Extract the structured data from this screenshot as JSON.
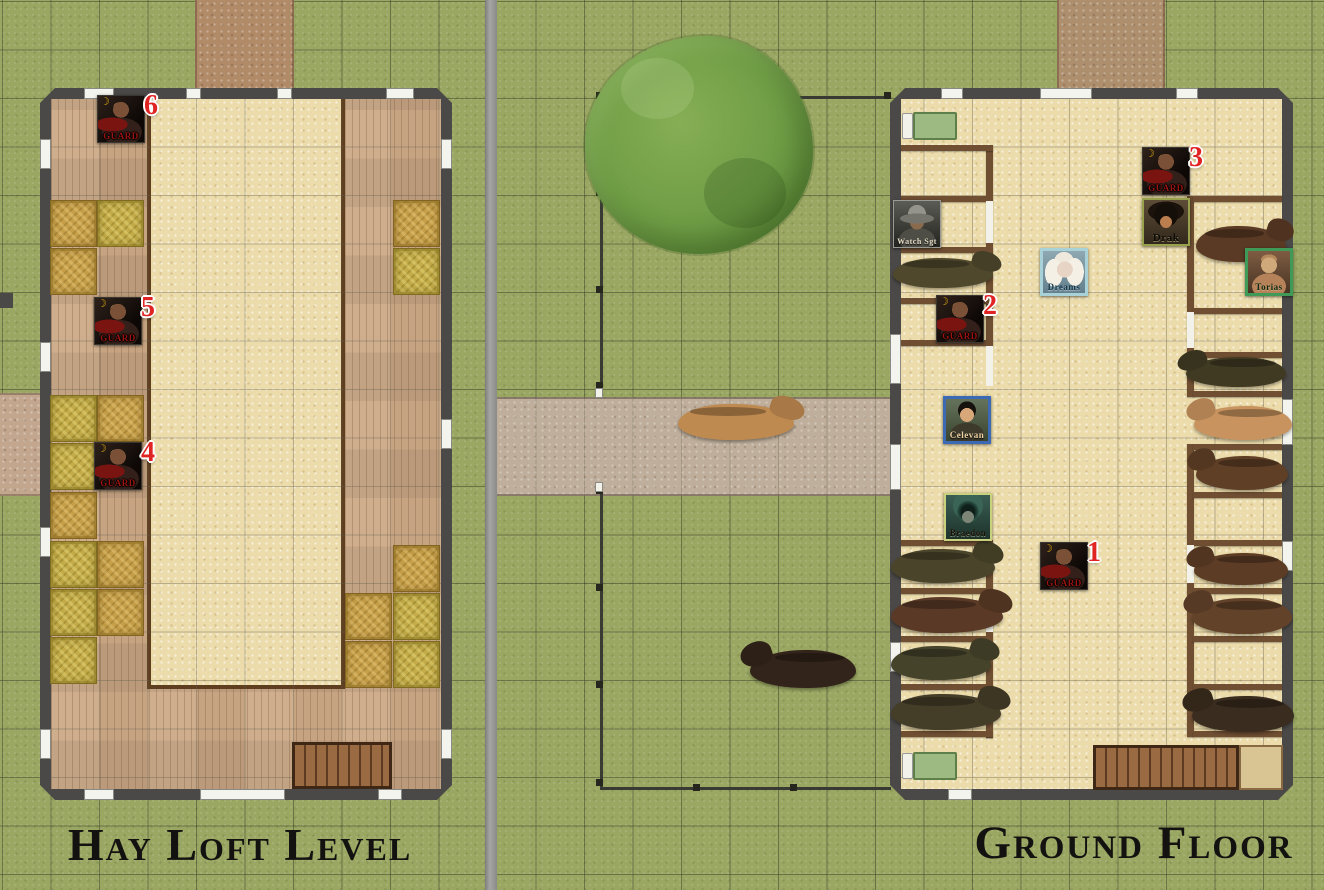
{
  "left_panel": {
    "title": "Hay Loft Level",
    "tokens": [
      {
        "id": "guard-6",
        "type": "guard",
        "label": "Guard",
        "number": "6",
        "status_icon": "crescent",
        "x": 97,
        "y": 95
      },
      {
        "id": "guard-5",
        "type": "guard",
        "label": "Guard",
        "number": "5",
        "status_icon": "crescent",
        "x": 94,
        "y": 297
      },
      {
        "id": "guard-4",
        "type": "guard",
        "label": "Guard",
        "number": "4",
        "status_icon": "crescent",
        "x": 94,
        "y": 442
      }
    ],
    "hay_bales": [
      [
        50,
        200
      ],
      [
        97,
        200
      ],
      [
        50,
        248
      ],
      [
        50,
        395
      ],
      [
        97,
        395
      ],
      [
        50,
        443
      ],
      [
        50,
        492
      ],
      [
        50,
        541
      ],
      [
        97,
        541
      ],
      [
        50,
        589
      ],
      [
        97,
        589
      ],
      [
        50,
        637
      ],
      [
        393,
        200
      ],
      [
        393,
        248
      ],
      [
        393,
        545
      ],
      [
        393,
        593
      ],
      [
        345,
        593
      ],
      [
        393,
        641
      ],
      [
        345,
        641
      ]
    ]
  },
  "right_panel": {
    "title": "Ground Floor",
    "tokens": [
      {
        "id": "watch-sgt",
        "type": "sgt",
        "label": "Watch Sgt",
        "x": 893,
        "y": 200
      },
      {
        "id": "guard-2",
        "type": "guard",
        "label": "Guard",
        "number": "2",
        "status_icon": "crescent",
        "x": 936,
        "y": 295
      },
      {
        "id": "celevan",
        "type": "celevan",
        "label": "Celevan",
        "x": 943,
        "y": 396
      },
      {
        "id": "braedon",
        "type": "braedon",
        "label": "Braedon",
        "x": 944,
        "y": 493
      },
      {
        "id": "guard-1",
        "type": "guard",
        "label": "Guard",
        "number": "1",
        "status_icon": "crescent",
        "x": 1040,
        "y": 542
      },
      {
        "id": "guard-3",
        "type": "guard",
        "label": "Guard",
        "number": "3",
        "status_icon": "crescent",
        "x": 1142,
        "y": 147
      },
      {
        "id": "drak",
        "type": "drak",
        "label": "Drak",
        "x": 1142,
        "y": 198
      },
      {
        "id": "dreams",
        "type": "dreams",
        "label": "Dreams",
        "x": 1040,
        "y": 248
      },
      {
        "id": "torias",
        "type": "torias",
        "label": "Torias",
        "x": 1245,
        "y": 248
      }
    ],
    "horses": [
      {
        "name": "horse-stall-a1",
        "x": 893,
        "y": 258,
        "w": 100,
        "h": 30,
        "color": "#4f482c",
        "head": "right"
      },
      {
        "name": "horse-stall-b1",
        "x": 1196,
        "y": 226,
        "w": 90,
        "h": 36,
        "color": "#5a3a24",
        "head": "right"
      },
      {
        "name": "horse-stall-b2",
        "x": 1186,
        "y": 357,
        "w": 100,
        "h": 30,
        "color": "#403a22",
        "head": "left"
      },
      {
        "name": "horse-stall-b3",
        "x": 1194,
        "y": 406,
        "w": 98,
        "h": 34,
        "color": "#c8935e",
        "head": "left"
      },
      {
        "name": "horse-stall-b4",
        "x": 1196,
        "y": 456,
        "w": 92,
        "h": 34,
        "color": "#5f3f26",
        "head": "left"
      },
      {
        "name": "horse-stall-a2",
        "x": 891,
        "y": 549,
        "w": 104,
        "h": 34,
        "color": "#4a452a",
        "head": "right"
      },
      {
        "name": "horse-stall-a3",
        "x": 891,
        "y": 597,
        "w": 112,
        "h": 36,
        "color": "#5a3a26",
        "head": "right"
      },
      {
        "name": "horse-stall-a4",
        "x": 891,
        "y": 646,
        "w": 100,
        "h": 34,
        "color": "#45432a",
        "head": "right"
      },
      {
        "name": "horse-stall-a5",
        "x": 891,
        "y": 694,
        "w": 110,
        "h": 36,
        "color": "#443d28",
        "head": "right"
      },
      {
        "name": "horse-stall-b5",
        "x": 1194,
        "y": 553,
        "w": 94,
        "h": 32,
        "color": "#5c3c24",
        "head": "left"
      },
      {
        "name": "horse-stall-b6",
        "x": 1192,
        "y": 598,
        "w": 100,
        "h": 36,
        "color": "#63422a",
        "head": "left"
      },
      {
        "name": "horse-stall-b7",
        "x": 1192,
        "y": 696,
        "w": 102,
        "h": 36,
        "color": "#3a2c1e",
        "head": "left"
      },
      {
        "name": "horse-yard",
        "x": 750,
        "y": 650,
        "w": 106,
        "h": 38,
        "color": "#32241a",
        "head": "left"
      },
      {
        "name": "horse-path",
        "x": 678,
        "y": 404,
        "w": 116,
        "h": 36,
        "color": "#bf8a50",
        "head": "right"
      }
    ]
  },
  "colors": {
    "number_badge": "#e02424",
    "guard_label": "#9c1410",
    "grass": "#9aa762",
    "barn_wall": "#4b4947",
    "wood_floor": "#c6a482",
    "stone_floor": "#ecdcab",
    "hay": "#c3ac49",
    "stall_wall": "#6f4e32",
    "celevan_border": "#3b69b4",
    "dreams_border": "#a9d2d8",
    "torias_border": "#3f9a58",
    "braedon_border": "#c9d07e",
    "drak_border": "#98a24c",
    "sgt_border": "#9a9a94"
  }
}
